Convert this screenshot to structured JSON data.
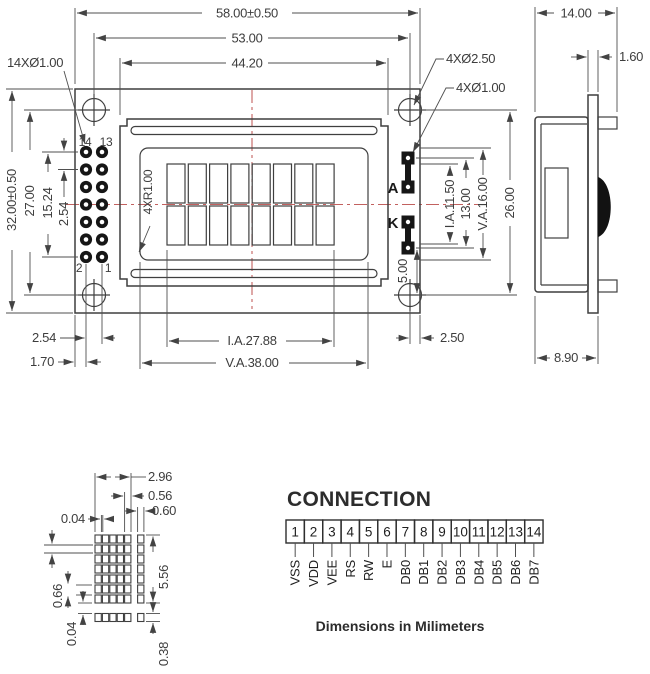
{
  "front_view": {
    "dims_top": {
      "overall": "58.00±0.50",
      "hole_span": "53.00",
      "bezel": "44.20"
    },
    "labels": {
      "pin_holes": "14XØ1.00",
      "mount_holes": "4XØ2.50",
      "backlight_holes": "4XØ1.00",
      "corner_radius": "4XR1.00",
      "anode": "A",
      "cathode": "K"
    },
    "dims_left": {
      "overall": "32.00±0.50",
      "hole_span": "27.00",
      "pin_span": "15.24",
      "pin_pitch": "2.54"
    },
    "dims_right": {
      "inner_area": "I.A.11.50",
      "pin_span": "13.00",
      "view_area": "V.A.16.00",
      "hole_span": "26.00",
      "pin_offset": "5.00"
    },
    "dims_bottom": {
      "inner_area": "I.A.27.88",
      "view_area": "V.A.38.00",
      "col_pitch": "2.54",
      "edge_offset": "1.70",
      "hole_edge": "2.50"
    },
    "pin_numbers": {
      "top_left": "14",
      "top_right": "13",
      "bottom_left": "2",
      "bottom_right": "1"
    }
  },
  "side_view": {
    "dims": {
      "width": "14.00",
      "pcb_thickness": "1.60",
      "depth": "8.90"
    }
  },
  "detail_view": {
    "dims": {
      "char_width": "2.96",
      "dot_width": "0.56",
      "col_pitch": "0.60",
      "col_gap": "0.04",
      "dot_height": "0.66",
      "row_gap": "0.04",
      "char_height": "5.56",
      "row_offset": "0.38"
    }
  },
  "connection": {
    "title": "CONNECTION",
    "pins": [
      {
        "number": "1",
        "label": "VSS"
      },
      {
        "number": "2",
        "label": "VDD"
      },
      {
        "number": "3",
        "label": "VEE"
      },
      {
        "number": "4",
        "label": "RS"
      },
      {
        "number": "5",
        "label": "RW"
      },
      {
        "number": "6",
        "label": "E"
      },
      {
        "number": "7",
        "label": "DB0"
      },
      {
        "number": "8",
        "label": "DB1"
      },
      {
        "number": "9",
        "label": "DB2"
      },
      {
        "number": "10",
        "label": "DB3"
      },
      {
        "number": "11",
        "label": "DB4"
      },
      {
        "number": "12",
        "label": "DB5"
      },
      {
        "number": "13",
        "label": "DB6"
      },
      {
        "number": "14",
        "label": "DB7"
      }
    ],
    "note": "Dimensions in Milimeters"
  },
  "colors": {
    "line": "#3f3f3f",
    "centerline": "#c2615f",
    "fill_dark": "#161616"
  }
}
